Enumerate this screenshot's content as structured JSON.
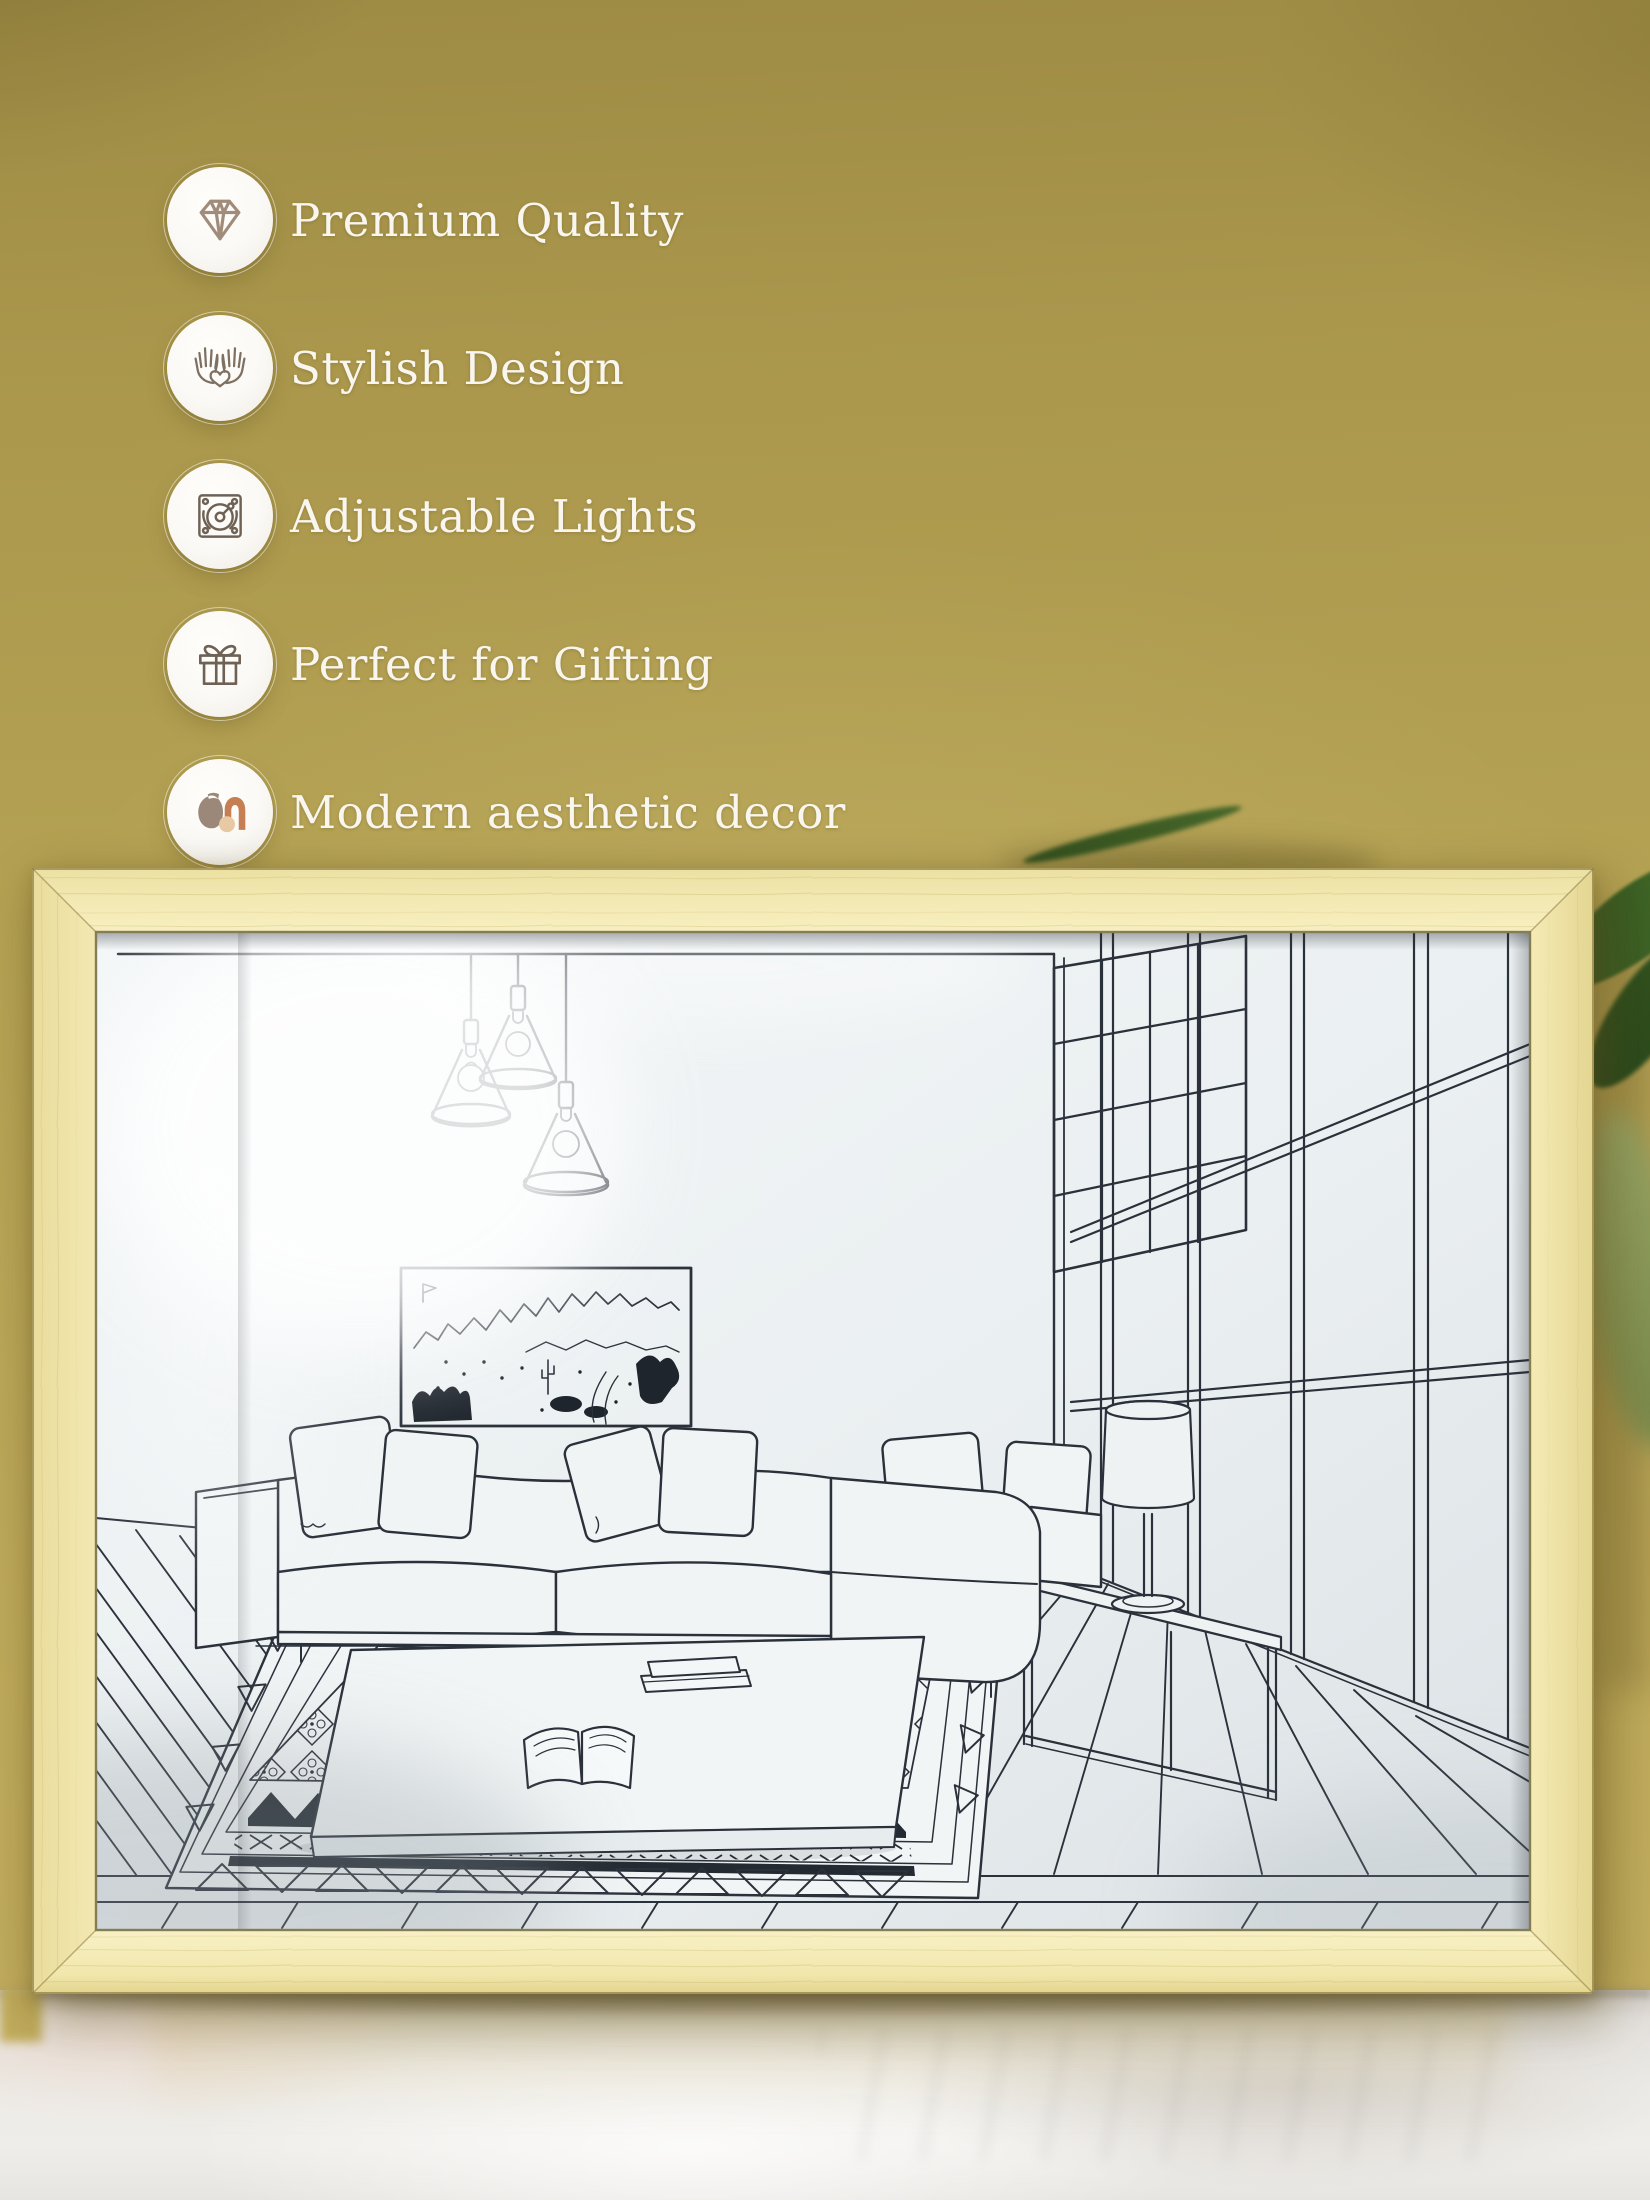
{
  "scene": {
    "type": "product-photo",
    "background": "mustard-wall",
    "surface": "marble-tabletop",
    "product": "wood-framed-light-drawing-of-living-room"
  },
  "features": [
    {
      "icon": "diamond-icon",
      "label": "Premium Quality"
    },
    {
      "icon": "hands-heart-icon",
      "label": "Stylish Design"
    },
    {
      "icon": "dimmer-dial-icon",
      "label": "Adjustable Lights"
    },
    {
      "icon": "gift-box-icon",
      "label": "Perfect for Gifting"
    },
    {
      "icon": "vase-decor-icon",
      "label": "Modern aesthetic decor"
    }
  ],
  "artwork_subjects": [
    "pendant-lights",
    "mountain-wall-art",
    "sectional-sofa",
    "throw-pillows",
    "coffee-table",
    "open-book",
    "stacked-books",
    "patterned-rug",
    "console-bench",
    "table-lamp",
    "floor-to-ceiling-windows",
    "wood-plank-floor"
  ],
  "colors": {
    "wall": "#b29f51",
    "frame_wood": "#f2e7af",
    "art_panel": "#ecf0f1",
    "line_art": "#2b313b",
    "feature_text": "#f8f6ee",
    "icon_stroke": "#847564",
    "icon_diamond": "#a18c7b",
    "icon_vase": "#9b8878",
    "icon_arch": "#c67f53",
    "icon_circle": "#e9c8a4",
    "badge_bg": "#fcfbf8",
    "marble": "#e8e6e2",
    "plant": "#3f6427"
  }
}
